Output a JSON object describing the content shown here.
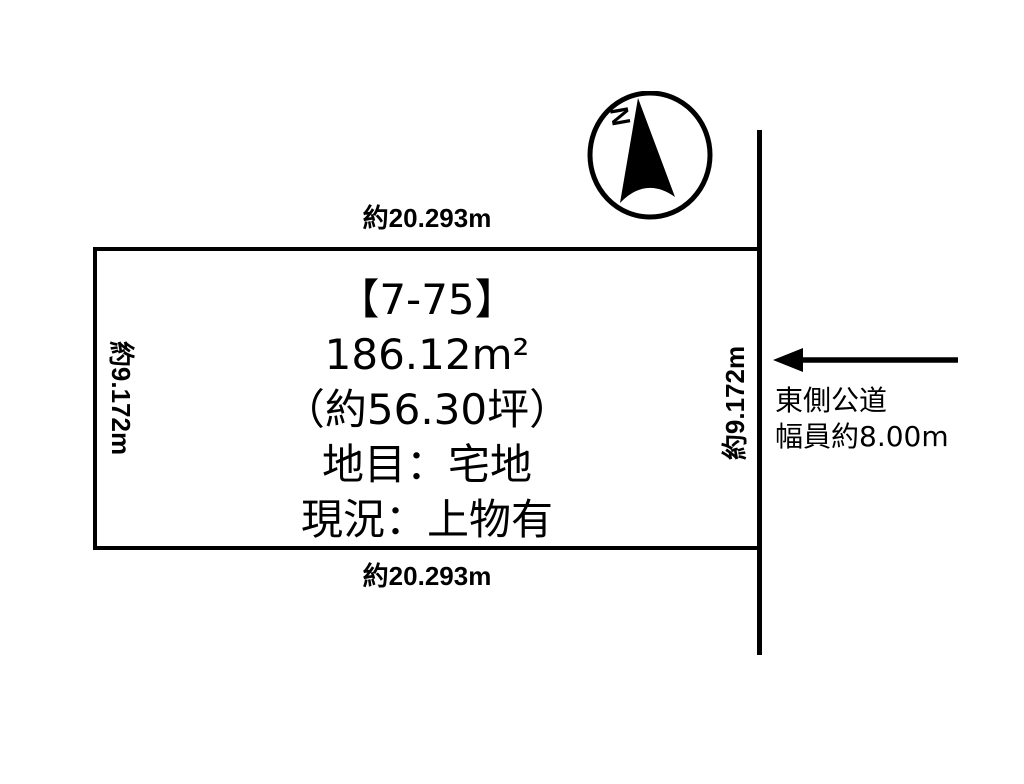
{
  "diagram": {
    "background": "#ffffff",
    "line_color": "#000000"
  },
  "compass": {
    "north_label": "N"
  },
  "plot": {
    "lot_number": "【7-75】",
    "area_m2": "186.12m²",
    "area_tsubo": "（約56.30坪）",
    "land_category": "地目：宅地",
    "current_state": "現況：上物有"
  },
  "dimensions": {
    "top": "約20.293m",
    "bottom": "約20.293m",
    "left": "約9.172m",
    "right": "約9.172m"
  },
  "road": {
    "name": "東側公道",
    "width": "幅員約8.00m"
  }
}
